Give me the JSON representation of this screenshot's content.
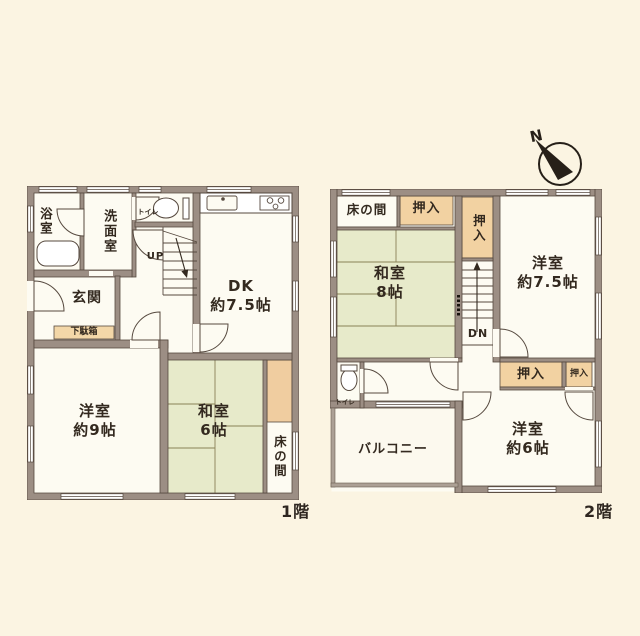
{
  "colors": {
    "background": "#FBF4E2",
    "wall": "#9C8E84",
    "wall_outline": "#56493F",
    "room": "#FDFBF2",
    "tatami": "#E7EACA",
    "closet": "#F2D2A2",
    "text": "#33291F"
  },
  "compass": {
    "label": "N"
  },
  "floor1": {
    "label": "1階",
    "bath": "浴室",
    "washroom": "洗面室",
    "toilet": "トイレ",
    "stairs": "UP",
    "dk": {
      "name": "DK",
      "size": "約7.5帖"
    },
    "entrance": "玄関",
    "shoe_cabinet": "下駄箱",
    "western_room_9": {
      "name": "洋室",
      "size": "約9帖"
    },
    "japanese_room_6": {
      "name": "和室",
      "size": "6帖"
    },
    "tokonoma": "床の間"
  },
  "floor2": {
    "label": "2階",
    "tokonoma": "床の間",
    "closet_top": "押入",
    "closet_middle": "押入",
    "japanese_room_8": {
      "name": "和室",
      "size": "8帖"
    },
    "western_room_7_5": {
      "name": "洋室",
      "size": "約7.5帖"
    },
    "stairs": "DN",
    "toilet": "トイレ",
    "closet_left": "押入",
    "closet_right": "押入",
    "western_room_6": {
      "name": "洋室",
      "size": "約6帖"
    },
    "balcony": "バルコニー"
  }
}
